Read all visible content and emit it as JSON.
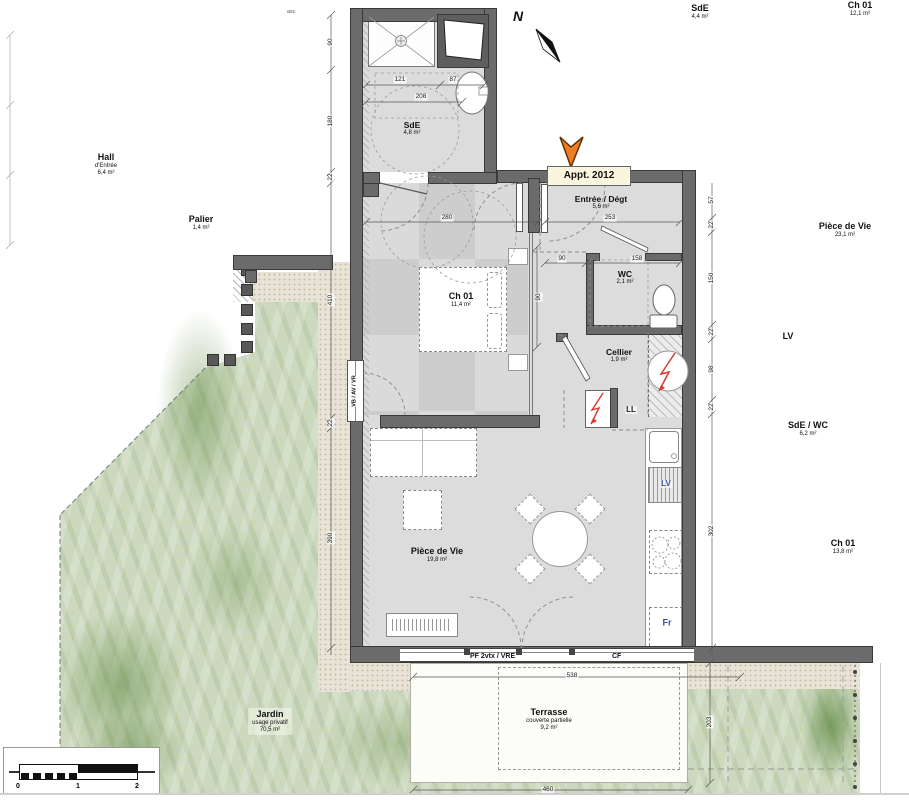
{
  "plan": {
    "marker_label": "Appt. 2012",
    "north": "N",
    "asc": "asc",
    "rooms": {
      "sde": {
        "name": "SdE",
        "area": "4,8 m²"
      },
      "ch01": {
        "name": "Ch 01",
        "area": "11,4 m²"
      },
      "entree": {
        "name": "Entrée / Dégt",
        "area": "5,6 m²"
      },
      "wc": {
        "name": "WC",
        "area": "2,1 m²"
      },
      "cellier": {
        "name": "Cellier",
        "area": "1,9 m²"
      },
      "vie": {
        "name": "Pièce de Vie",
        "area": "19,8 m²"
      },
      "terrasse": {
        "name": "Terrasse",
        "sub": "couverte partielle",
        "area": "9,2 m²"
      },
      "jardin": {
        "name": "Jardin",
        "sub": "usage privatif",
        "area": "70,5 m²"
      }
    },
    "appliances": {
      "ll": "LL",
      "lv": "LV",
      "fr": "Fr"
    },
    "windows": {
      "left": "VB / AV / VR",
      "bay": "PF 2vtx / VRE",
      "fixed": "CF"
    },
    "neighbors": {
      "hall": {
        "name": "Hall",
        "sub": "d'Entrée",
        "area": "6,4 m²"
      },
      "palier": {
        "name": "Palier",
        "area": "1,4 m²"
      },
      "sde": {
        "name": "SdE",
        "area": "4,4 m²"
      },
      "ch01_top": {
        "name": "Ch 01",
        "area": "12,1 m²"
      },
      "vie": {
        "name": "Pièce de Vie",
        "area": "23,1 m²"
      },
      "lv": {
        "name": "LV"
      },
      "sdewc": {
        "name": "SdE / WC",
        "area": "6,2 m²"
      },
      "ch01_right": {
        "name": "Ch 01",
        "area": "13,8 m²"
      }
    },
    "dims": {
      "sde_a": "121",
      "sde_b": "87",
      "sde_c": "208",
      "bed_w": "280",
      "bed_s": "90",
      "ent_w": "253",
      "wc_a": "90",
      "wc_b": "158",
      "left_chain": [
        "90",
        "180",
        "22",
        "410",
        "22",
        "390"
      ],
      "right_chain": [
        "57",
        "22",
        "150",
        "22",
        "98",
        "22",
        "302"
      ],
      "ter_top": "538",
      "ter_bot": "460",
      "ter_side": "203"
    },
    "scale": {
      "t0": "0",
      "t1": "1",
      "t2": "2"
    }
  },
  "colors": {
    "wall": "#6b6b6b",
    "floor": "#dcdcdc",
    "garden": "#ccd9bf",
    "accent_orange": "#ee7c23",
    "appliance_blue": "#3c4f9c",
    "zigzag_red": "#d43a34"
  }
}
